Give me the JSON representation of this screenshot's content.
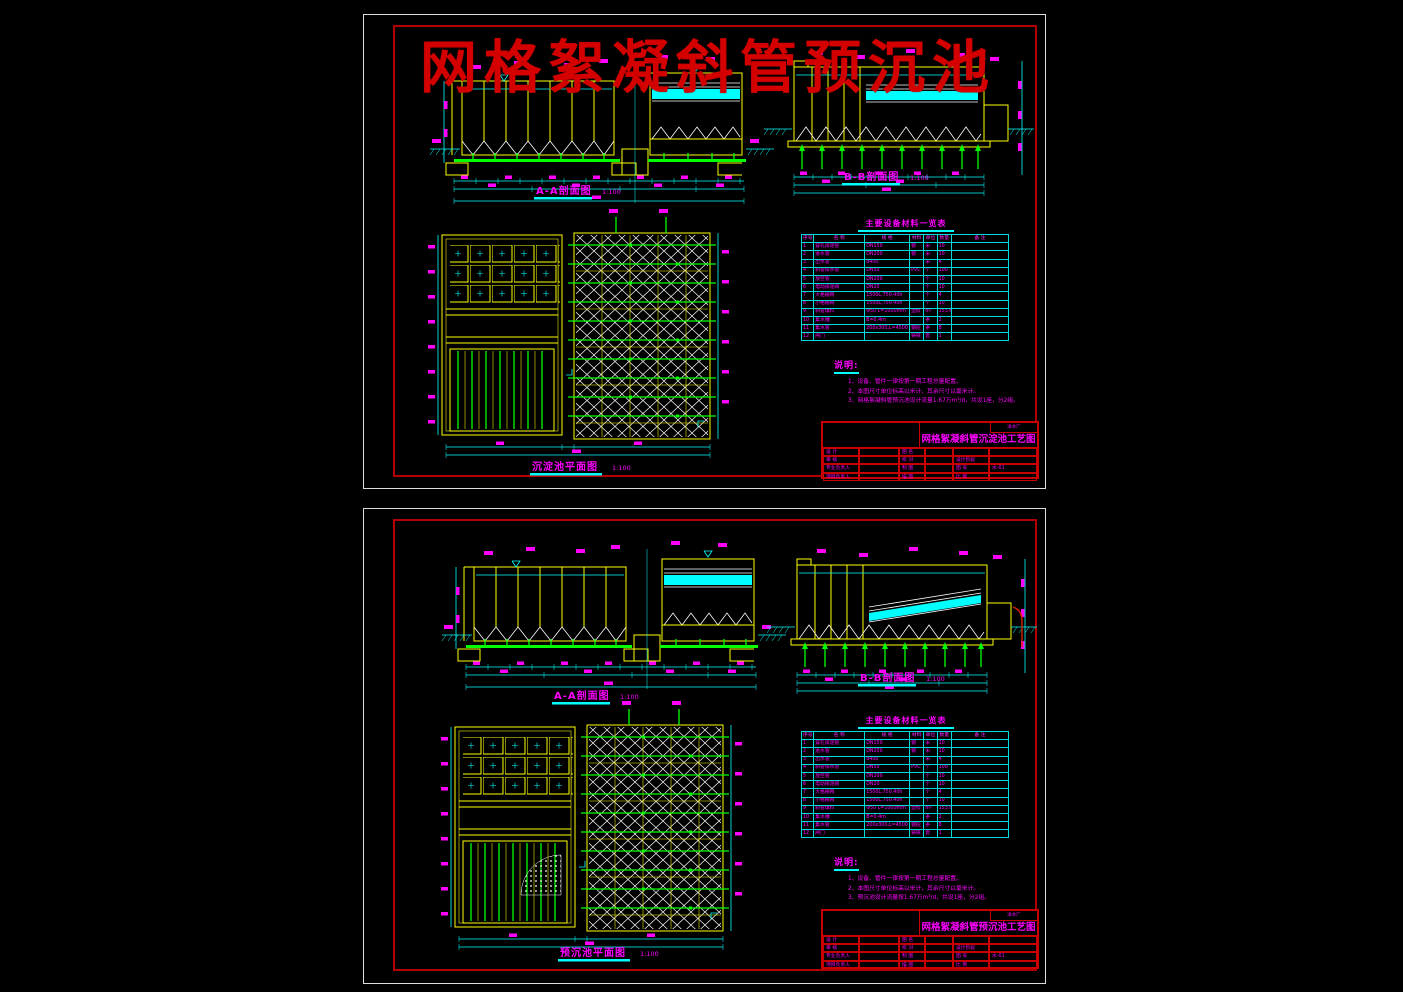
{
  "overlay_title": "网格絮凝斜管预沉池",
  "colors": {
    "background": "#000000",
    "sheet_border": "#dcdcdc",
    "frame_red": "#b40000",
    "cad_yellow": "#ffff00",
    "cad_cyan": "#00ffff",
    "cad_green": "#00ff00",
    "cad_magenta": "#ff00ff",
    "cad_white": "#ffffff",
    "watermark_red": "#d40000"
  },
  "sheet1": {
    "section_aa_label": "A-A剖面图",
    "section_aa_scale": "1:100",
    "section_bb_label": "B-B剖面图",
    "section_bb_scale": "1:100",
    "plan_label": "沉淀池平面图",
    "plan_scale": "1:100",
    "table_title": "主要设备材料一览表",
    "table_headers": [
      "序号",
      "名  称",
      "规  格",
      "材料",
      "单位",
      "数量",
      "备  注"
    ],
    "table_rows": [
      [
        "1",
        "穿孔排泥管",
        "DN150",
        "钢",
        "米",
        "10",
        ""
      ],
      [
        "2",
        "进水管",
        "DN200",
        "钢",
        "米",
        "10",
        ""
      ],
      [
        "3",
        "出水管",
        "d400",
        "",
        "米",
        "4",
        ""
      ],
      [
        "4",
        "斜管排水管",
        "DN50",
        "PVC",
        "个",
        "100",
        ""
      ],
      [
        "5",
        "放空管",
        "DN200",
        "",
        "个",
        "10",
        ""
      ],
      [
        "6",
        "电动排泥阀",
        "DN20",
        "",
        "个",
        "10",
        ""
      ],
      [
        "7",
        "大格栅网",
        "1500L,750.40h",
        "",
        "个",
        "4",
        ""
      ],
      [
        "8",
        "小格栅网",
        "1500L,750.40h",
        "",
        "个",
        "10",
        ""
      ],
      [
        "9",
        "斜管填料",
        "Φ50 L=1000mm",
        "塑料",
        "m²",
        "153.6",
        ""
      ],
      [
        "10",
        "集水槽",
        "B=0.4m",
        "",
        "条",
        "2",
        ""
      ],
      [
        "11",
        "集水管",
        "200x300,L=4500",
        "钢砼",
        "条",
        "8",
        ""
      ],
      [
        "12",
        "闸门",
        "",
        "铸铁",
        "套",
        "1",
        ""
      ]
    ],
    "notes_title": "说明:",
    "notes": [
      "1、设备、管件一律按第一期工程总量配置。",
      "2、本图尺寸单位标高以米计，其余尺寸以毫米计。",
      "3、网格絮凝斜管预沉池设计流量1.67万m³/d，共设1座，分2组。"
    ],
    "titleblock": {
      "corner": "净水厂",
      "drawing_title": "网格絮凝斜管沉淀池工艺图",
      "rows": [
        [
          "设  计",
          "",
          "图  名",
          "",
          "",
          ""
        ],
        [
          "审  核",
          "",
          "校  对",
          "",
          "设计阶段",
          ""
        ],
        [
          "专业负责人",
          "",
          "制  图",
          "",
          "图  号",
          "水-01"
        ],
        [
          "项目负责人",
          "",
          "描  图",
          "",
          "比  例",
          ""
        ]
      ]
    }
  },
  "sheet2": {
    "section_aa_label": "A-A剖面图",
    "section_aa_scale": "1:100",
    "section_bb_label": "B-B剖面图",
    "section_bb_scale": "1:100",
    "plan_label": "预沉池平面图",
    "plan_scale": "1:100",
    "table_title": "主要设备材料一览表",
    "table_headers": [
      "序号",
      "名  称",
      "规  格",
      "材料",
      "单位",
      "数量",
      "备  注"
    ],
    "table_rows": [
      [
        "1",
        "穿孔排泥管",
        "DN150",
        "钢",
        "米",
        "10",
        ""
      ],
      [
        "2",
        "进水管",
        "DN200",
        "钢",
        "米",
        "10",
        ""
      ],
      [
        "3",
        "出水管",
        "d400",
        "",
        "米",
        "4",
        ""
      ],
      [
        "4",
        "斜管排水管",
        "DN50",
        "PVC",
        "个",
        "100",
        ""
      ],
      [
        "5",
        "放空管",
        "DN200",
        "",
        "个",
        "10",
        ""
      ],
      [
        "6",
        "电动排泥阀",
        "DN20",
        "",
        "个",
        "10",
        ""
      ],
      [
        "7",
        "大格栅网",
        "1500L,750.40h",
        "",
        "个",
        "4",
        ""
      ],
      [
        "8",
        "小格栅网",
        "1500L,750.40h",
        "",
        "个",
        "10",
        ""
      ],
      [
        "9",
        "斜管填料",
        "Φ50 L=1000mm",
        "塑料",
        "m²",
        "153.6",
        ""
      ],
      [
        "10",
        "集水槽",
        "B=0.4m",
        "",
        "条",
        "2",
        ""
      ],
      [
        "11",
        "集水管",
        "200x300,L=4500",
        "钢砼",
        "条",
        "8",
        ""
      ],
      [
        "12",
        "闸门",
        "",
        "铸铁",
        "套",
        "1",
        ""
      ]
    ],
    "notes_title": "说明:",
    "notes": [
      "1、设备、管件一律按第一期工程总量配置。",
      "2、本图尺寸单位标高以米计，其余尺寸以毫米计。",
      "3、预沉池设计流量按1.67万m³/d，共设1座，分2组。"
    ],
    "titleblock": {
      "corner": "净水厂",
      "drawing_title": "网格絮凝斜管预沉池工艺图",
      "rows": [
        [
          "设  计",
          "",
          "图  名",
          "",
          "",
          ""
        ],
        [
          "审  核",
          "",
          "校  对",
          "",
          "设计阶段",
          ""
        ],
        [
          "专业负责人",
          "",
          "制  图",
          "",
          "图  号",
          "水-01"
        ],
        [
          "项目负责人",
          "",
          "描  图",
          "",
          "比  例",
          ""
        ]
      ]
    }
  }
}
